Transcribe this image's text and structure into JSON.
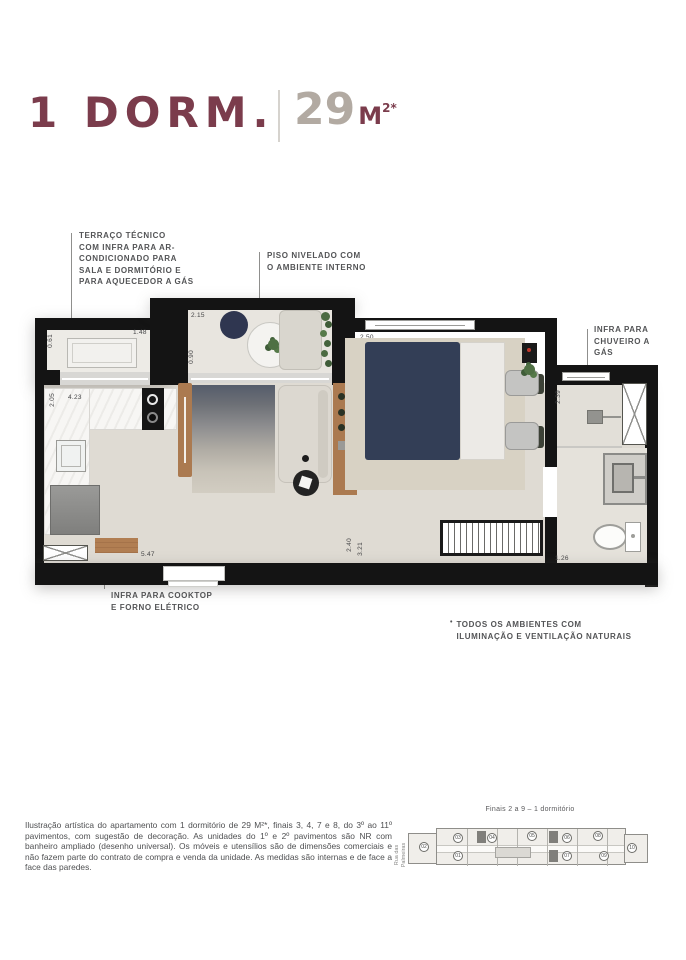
{
  "header": {
    "title": "1 DORM.",
    "area_value": "29",
    "area_unit": "M",
    "area_sup": "2*"
  },
  "annotations": {
    "terrace": {
      "lines": [
        "TERRAÇO TÉCNICO",
        "COM INFRA PARA AR-",
        "CONDICIONADO PARA",
        "SALA E DORMITÓRIO E",
        "PARA AQUECEDOR A GÁS"
      ]
    },
    "piso": {
      "lines": [
        "PISO NIVELADO COM",
        "O AMBIENTE INTERNO"
      ]
    },
    "chuveiro": {
      "lines": [
        "INFRA PARA",
        "CHUVEIRO A",
        "GÁS"
      ]
    },
    "cooktop": {
      "lines": [
        "INFRA PARA COOKTOP",
        "E FORNO ELÉTRICO"
      ]
    },
    "features": {
      "marker": "•",
      "lines": [
        "TODOS OS AMBIENTES COM",
        "ILUMINAÇÃO E VENTILAÇÃO NATURAIS"
      ]
    }
  },
  "plan": {
    "dimensions": {
      "terrace_depth": "0.61",
      "terrace_width": "1.48",
      "balcony_width": "2.15",
      "balcony_depth": "0.90",
      "bedroom_width": "2.50",
      "kitchen_depth": "2.05",
      "kitchen_width": "4.23",
      "bath_depth": "2.39",
      "living_length": "5.47",
      "hall_depth": "2.40",
      "hall_length": "3.21",
      "bath_width": "1.26"
    }
  },
  "keyplan": {
    "title": "Finais 2 a 9 – 1 dormitório",
    "street_line1": "Rua das",
    "street_line2": "Palmeiras",
    "units": [
      "01",
      "02",
      "03",
      "04",
      "05",
      "06",
      "07",
      "08",
      "09",
      "10"
    ]
  },
  "disclaimer": "Ilustração artística do apartamento com 1 dormitório de 29 M²*, finais 3, 4, 7 e 8, do 3º ao 11º pavimentos, com sugestão de decoração. As unidades do 1º e 2º pavimentos são NR com banheiro ampliado (desenho universal). Os móveis e utensílios são de dimensões comerciais e não fazem parte do contrato de compra e venda da unidade. As medidas são internas e de face a face das paredes.",
  "colors": {
    "brand": "#7b3c4c",
    "muted": "#b2aaa2",
    "wall": "#141414"
  }
}
